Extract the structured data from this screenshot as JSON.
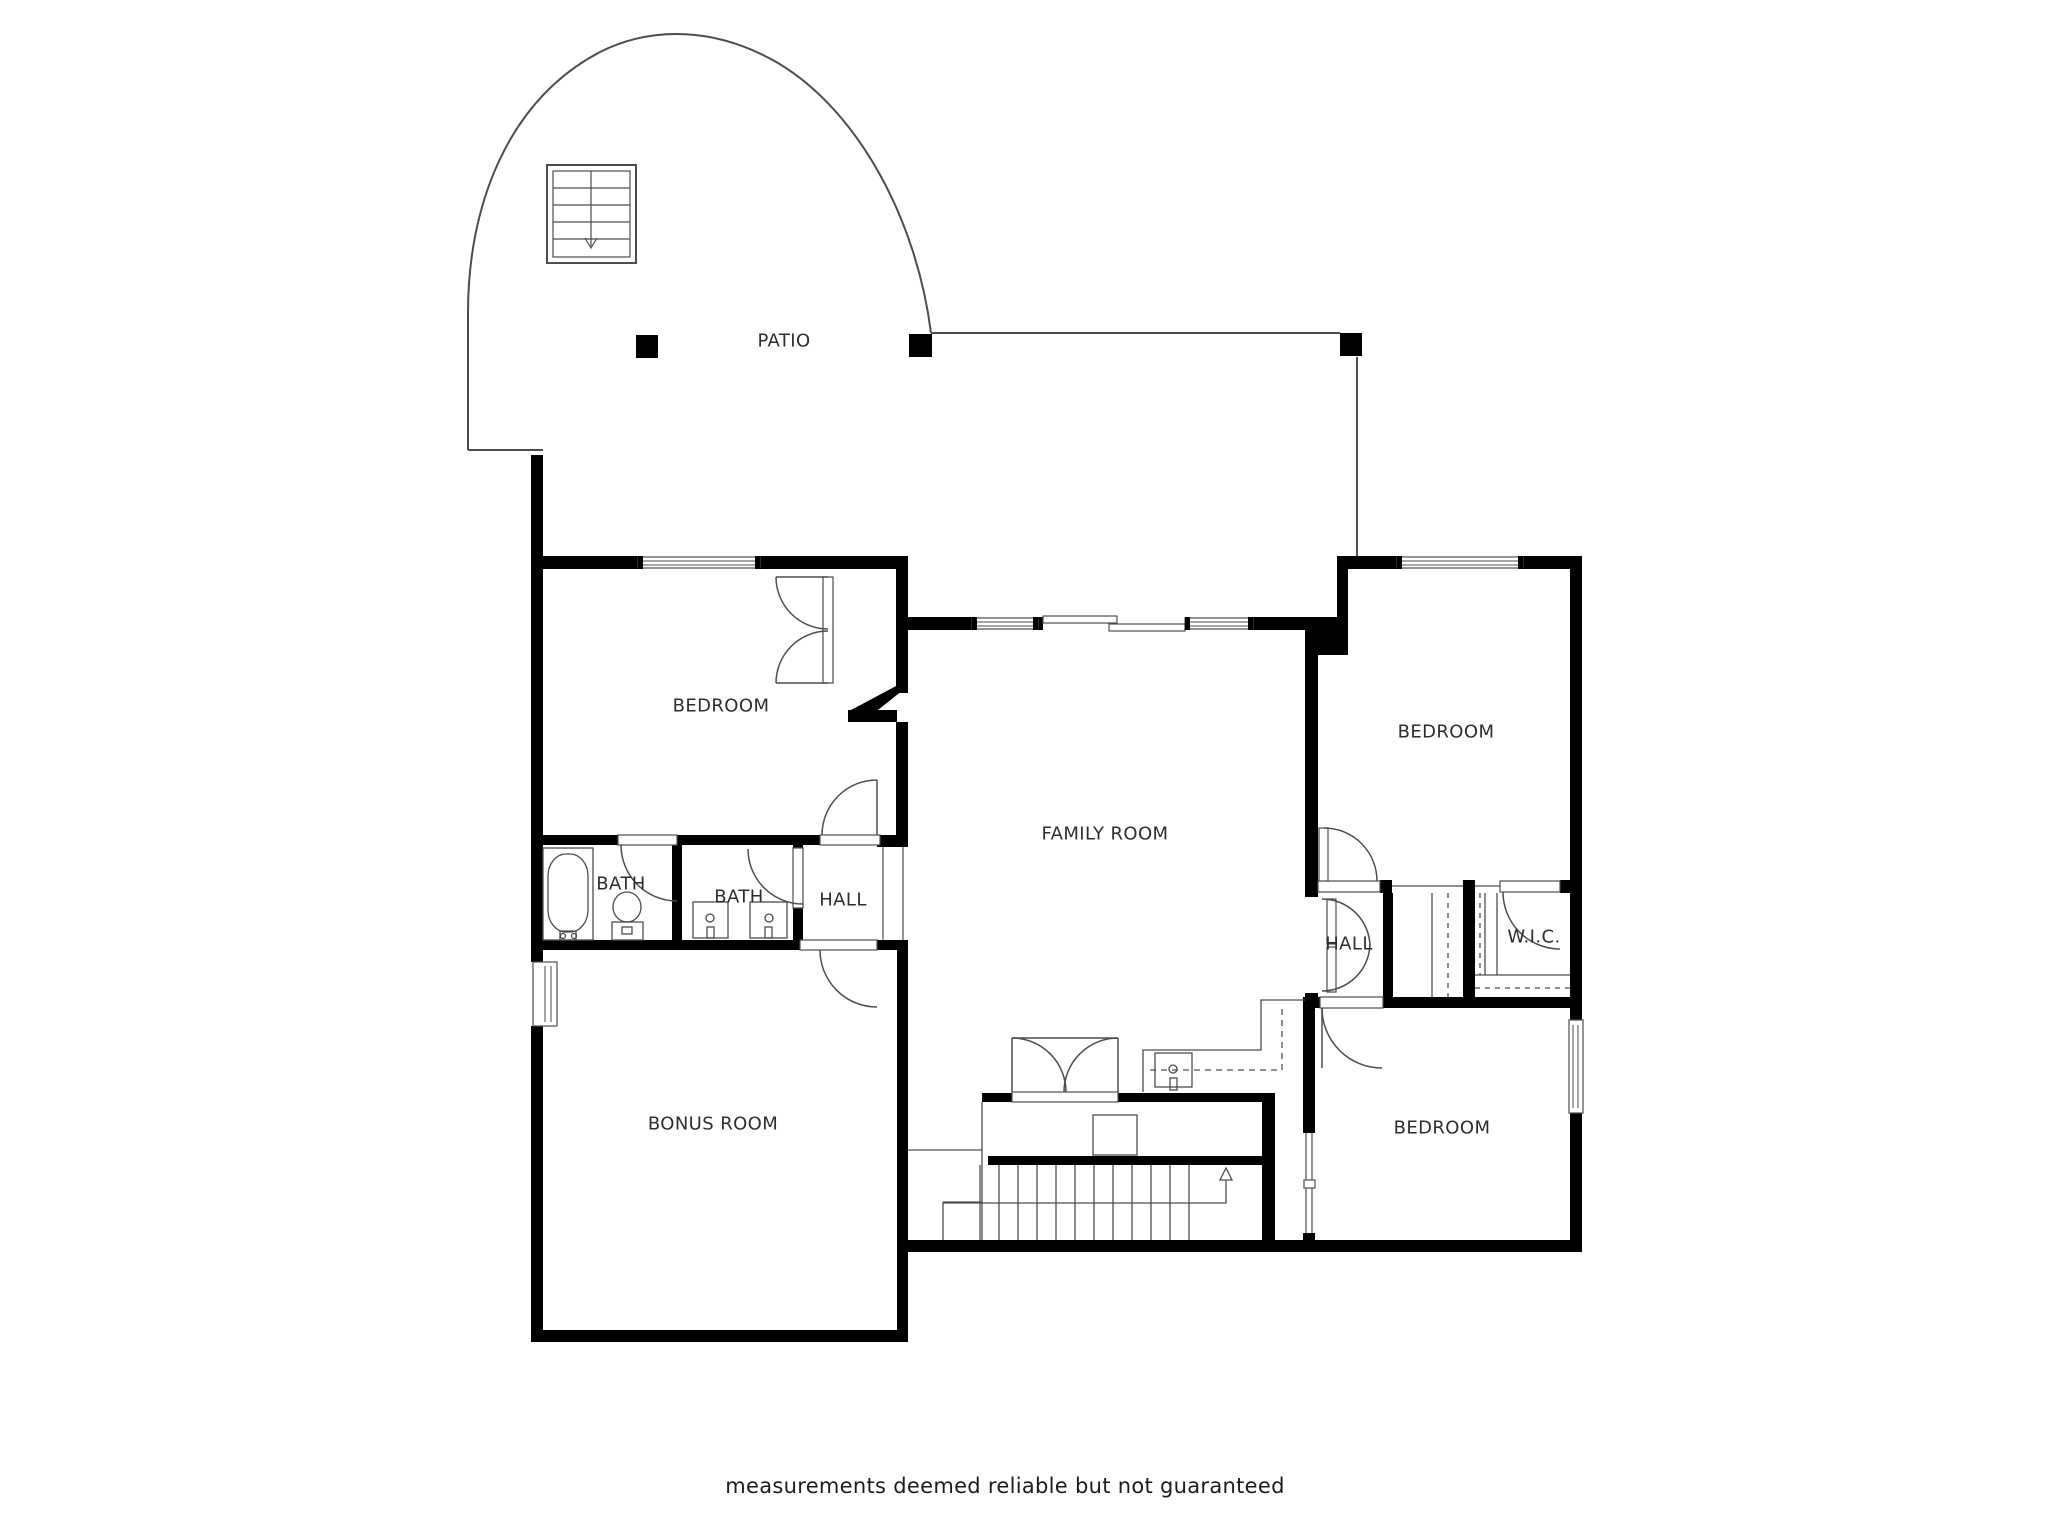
{
  "document": {
    "background": "#ffffff",
    "wall_color": "#000000",
    "line_color": "#4d4d4d",
    "text_color": "#2d2d2d"
  },
  "floor_plan": {
    "rooms": [
      {
        "id": "patio",
        "label": "PATIO"
      },
      {
        "id": "bedroom-top-left",
        "label": "BEDROOM"
      },
      {
        "id": "bath-1",
        "label": "BATH"
      },
      {
        "id": "bath-2",
        "label": "BATH"
      },
      {
        "id": "hall-left",
        "label": "HALL"
      },
      {
        "id": "family-room",
        "label": "FAMILY ROOM"
      },
      {
        "id": "bedroom-top-right",
        "label": "BEDROOM"
      },
      {
        "id": "hall-right",
        "label": "HALL"
      },
      {
        "id": "walk-in-closet",
        "label": "W.I.C."
      },
      {
        "id": "bonus-room",
        "label": "BONUS ROOM"
      },
      {
        "id": "bedroom-bottom-right",
        "label": "BEDROOM"
      }
    ],
    "disclaimer": "measurements deemed reliable but not guaranteed"
  }
}
